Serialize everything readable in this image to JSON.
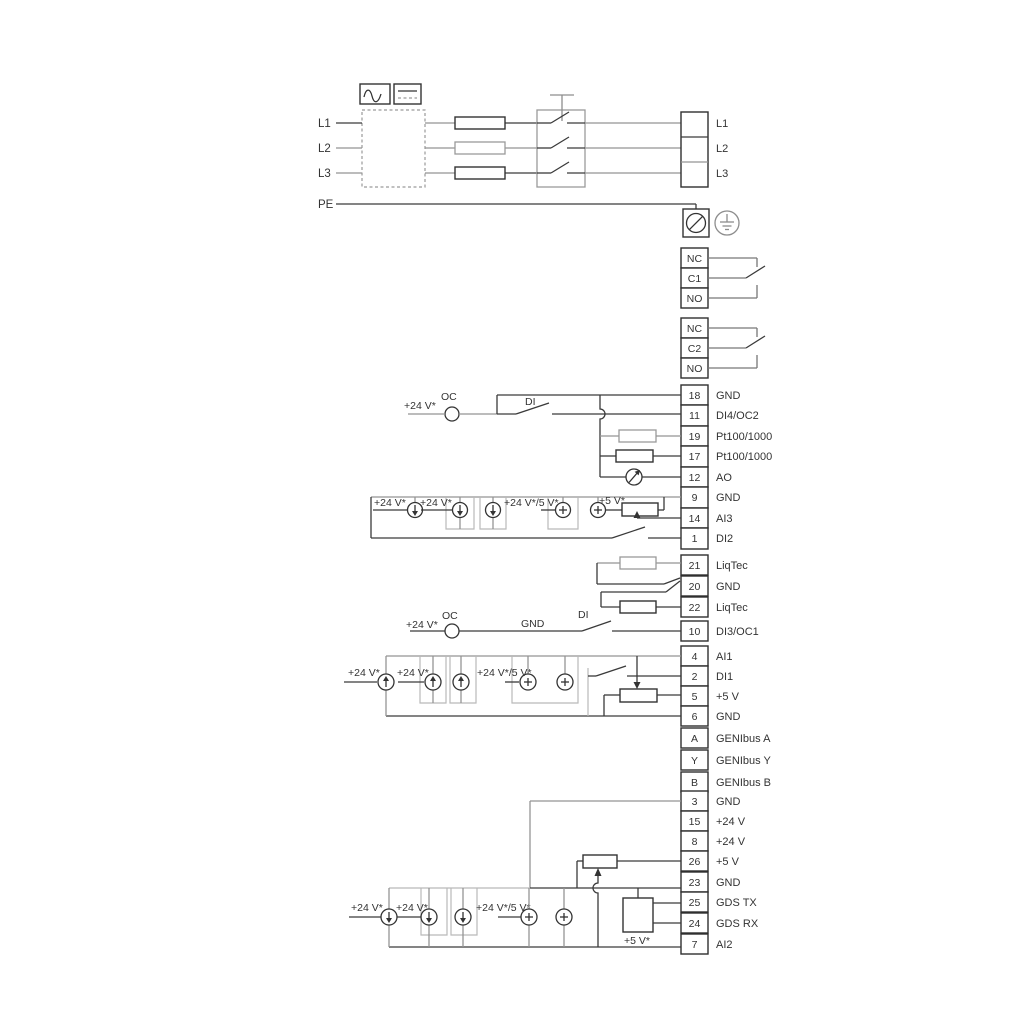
{
  "power": {
    "inputs": [
      "L1",
      "L2",
      "L3",
      "PE"
    ],
    "outputs": [
      "L1",
      "L2",
      "L3"
    ]
  },
  "relay1": [
    "NC",
    "C1",
    "NO"
  ],
  "relay2": [
    "NC",
    "C2",
    "NO"
  ],
  "io1": [
    {
      "num": "18",
      "label": "GND"
    },
    {
      "num": "11",
      "label": "DI4/OC2"
    },
    {
      "num": "19",
      "label": "Pt100/1000"
    },
    {
      "num": "17",
      "label": "Pt100/1000"
    },
    {
      "num": "12",
      "label": "AO"
    },
    {
      "num": "9",
      "label": "GND"
    },
    {
      "num": "14",
      "label": "AI3"
    },
    {
      "num": "1",
      "label": "DI2"
    }
  ],
  "liqtec": [
    {
      "num": "21",
      "label": "LiqTec"
    },
    {
      "num": "20",
      "label": "GND"
    },
    {
      "num": "22",
      "label": "LiqTec"
    }
  ],
  "io2": [
    {
      "num": "10",
      "label": "DI3/OC1"
    },
    {
      "num": "4",
      "label": "AI1"
    },
    {
      "num": "2",
      "label": "DI1"
    },
    {
      "num": "5",
      "label": "+5 V"
    },
    {
      "num": "6",
      "label": "GND"
    },
    {
      "num": "A",
      "label": "GENIbus A"
    },
    {
      "num": "Y",
      "label": "GENIbus Y"
    },
    {
      "num": "B",
      "label": "GENIbus B"
    }
  ],
  "io3": [
    {
      "num": "3",
      "label": "GND"
    },
    {
      "num": "15",
      "label": "+24 V"
    },
    {
      "num": "8",
      "label": "+24 V"
    },
    {
      "num": "26",
      "label": "+5 V"
    },
    {
      "num": "23",
      "label": "GND"
    },
    {
      "num": "25",
      "label": "GDS TX"
    },
    {
      "num": "24",
      "label": "GDS RX"
    },
    {
      "num": "7",
      "label": "AI2"
    }
  ],
  "ann": {
    "v24": "+24 V*",
    "v24or5": "+24 V*/5 V*",
    "v5": "+5 V*",
    "oc": "OC",
    "di": "DI",
    "gnd": "GND"
  },
  "colors": {
    "wire_gray": "#949494",
    "wire_black": "#3a3a3a",
    "background": "#ffffff"
  }
}
